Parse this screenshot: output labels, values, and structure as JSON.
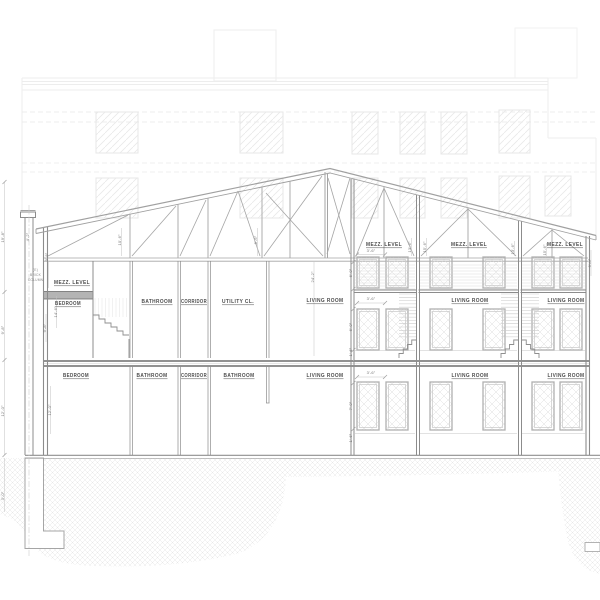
{
  "labels": {
    "left": {
      "mezz_level": "MEZZ. LEVEL",
      "mezz_room": "BEDROOM",
      "upper_rooms": [
        "BATHROOM",
        "CORRIDOR",
        "UTILITY CL."
      ],
      "lower_rooms": [
        "BEDROOM",
        "BATHROOM",
        "CORRIDOR",
        "BATHROOM"
      ]
    },
    "right": {
      "mezz_levels": [
        "MEZZ. LEVEL",
        "MEZZ. LEVEL",
        "MEZZ. LEVEL"
      ],
      "upper_rooms": [
        "LIVING ROOM",
        "LIVING ROOM",
        "LIVING ROOM"
      ],
      "lower_rooms": [
        "LIVING ROOM",
        "LIVING ROOM",
        "LIVING ROOM"
      ]
    },
    "column_note": [
      "(E)",
      "BRICK",
      "COLUMN"
    ]
  },
  "dimensions": [
    "4'-2\"",
    "3'-8\"",
    "10'-6\"",
    "8'-6\"",
    "14'-6\"",
    "9'-8\"",
    "12'-0\"",
    "24'-2\"",
    "6'-0\"",
    "6'-0\"",
    "1'-6\"",
    "7'-0\"",
    "1'-6\"",
    "3'-6\"",
    "3'-6\"",
    "3'-6\"",
    "13'-6\"",
    "15'-6\"",
    "13'-6\"",
    "15'-6\"",
    "9'-0\"",
    "19'-8\"",
    "9'-8\"",
    "12'-0\"",
    "3'-0\""
  ],
  "colors": {
    "background_line": "#ededed",
    "main_line": "#9a9a9a",
    "wall": "#8c8c8c",
    "truss": "#a5a5a5",
    "floor": "#6f6f6f",
    "window_hatch": "#dcdcdc",
    "ground_hatch": "#e3e3e3",
    "slab_fill": "#b4b4b4",
    "label_text": "#4c4c4c",
    "dim_text": "#757575"
  }
}
